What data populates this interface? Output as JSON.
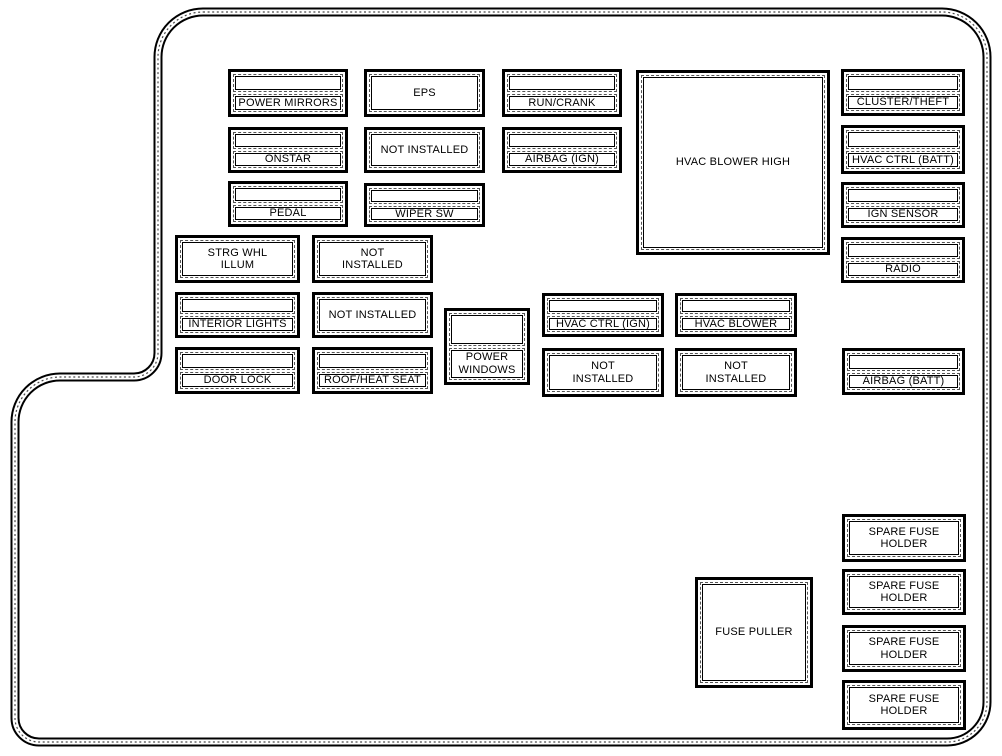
{
  "diagram": {
    "kind": "vehicle-fuse-box-diagram",
    "colors": {
      "line": "#000000",
      "background": "#ffffff"
    }
  },
  "fuses": [
    {
      "id": "power-mirrors",
      "label": "POWER MIRRORS",
      "slots": 2,
      "x": 228,
      "y": 69,
      "w": 120,
      "h": 48
    },
    {
      "id": "eps",
      "label": "EPS",
      "slots": 1,
      "x": 364,
      "y": 69,
      "w": 121,
      "h": 48
    },
    {
      "id": "run-crank",
      "label": "RUN/CRANK",
      "slots": 2,
      "x": 502,
      "y": 69,
      "w": 120,
      "h": 48
    },
    {
      "id": "hvac-blower-high",
      "label": "HVAC BLOWER HIGH",
      "slots": 1,
      "x": 636,
      "y": 70,
      "w": 194,
      "h": 185
    },
    {
      "id": "cluster-theft",
      "label": "CLUSTER/THEFT",
      "slots": 2,
      "x": 841,
      "y": 69,
      "w": 124,
      "h": 47
    },
    {
      "id": "onstar",
      "label": "ONSTAR",
      "slots": 2,
      "x": 228,
      "y": 127,
      "w": 120,
      "h": 46
    },
    {
      "id": "not-installed-a",
      "label": "NOT INSTALLED",
      "slots": 1,
      "x": 364,
      "y": 127,
      "w": 121,
      "h": 46
    },
    {
      "id": "airbag-ign",
      "label": "AIRBAG (IGN)",
      "slots": 2,
      "x": 502,
      "y": 127,
      "w": 120,
      "h": 46
    },
    {
      "id": "hvac-ctrl-batt",
      "label": "HVAC CTRL (BATT)",
      "slots": 2,
      "x": 841,
      "y": 125,
      "w": 124,
      "h": 49
    },
    {
      "id": "pedal",
      "label": "PEDAL",
      "slots": 2,
      "x": 228,
      "y": 181,
      "w": 120,
      "h": 46
    },
    {
      "id": "wiper-sw",
      "label": "WIPER SW",
      "slots": 2,
      "x": 364,
      "y": 183,
      "w": 121,
      "h": 44
    },
    {
      "id": "ign-sensor",
      "label": "IGN SENSOR",
      "slots": 2,
      "x": 841,
      "y": 182,
      "w": 124,
      "h": 46
    },
    {
      "id": "radio",
      "label": "RADIO",
      "slots": 2,
      "x": 841,
      "y": 237,
      "w": 124,
      "h": 46
    },
    {
      "id": "strg-whl-illum",
      "label": "STRG WHL\nILLUM",
      "slots": 1,
      "x": 175,
      "y": 235,
      "w": 125,
      "h": 48
    },
    {
      "id": "not-installed-b",
      "label": "NOT\nINSTALLED",
      "slots": 1,
      "x": 312,
      "y": 235,
      "w": 121,
      "h": 48
    },
    {
      "id": "interior-lights",
      "label": "INTERIOR LIGHTS",
      "slots": 2,
      "x": 175,
      "y": 292,
      "w": 125,
      "h": 46
    },
    {
      "id": "not-installed-c",
      "label": "NOT INSTALLED",
      "slots": 1,
      "x": 312,
      "y": 292,
      "w": 121,
      "h": 46
    },
    {
      "id": "hvac-ctrl-ign",
      "label": "HVAC CTRL (IGN)",
      "slots": 2,
      "x": 542,
      "y": 293,
      "w": 122,
      "h": 44
    },
    {
      "id": "hvac-blower",
      "label": "HVAC BLOWER",
      "slots": 2,
      "x": 675,
      "y": 293,
      "w": 122,
      "h": 44
    },
    {
      "id": "door-lock",
      "label": "DOOR LOCK",
      "slots": 2,
      "x": 175,
      "y": 347,
      "w": 125,
      "h": 47
    },
    {
      "id": "roof-heat-seat",
      "label": "ROOF/HEAT SEAT",
      "slots": 2,
      "x": 312,
      "y": 347,
      "w": 121,
      "h": 47
    },
    {
      "id": "power-windows",
      "label": "POWER\nWINDOWS",
      "slots": 2,
      "x": 444,
      "y": 308,
      "w": 86,
      "h": 77
    },
    {
      "id": "not-installed-d",
      "label": "NOT\nINSTALLED",
      "slots": 1,
      "x": 542,
      "y": 348,
      "w": 122,
      "h": 49
    },
    {
      "id": "not-installed-e",
      "label": "NOT\nINSTALLED",
      "slots": 1,
      "x": 675,
      "y": 348,
      "w": 122,
      "h": 49
    },
    {
      "id": "airbag-batt",
      "label": "AIRBAG (BATT)",
      "slots": 2,
      "x": 842,
      "y": 348,
      "w": 123,
      "h": 47
    },
    {
      "id": "fuse-puller",
      "label": "FUSE PULLER",
      "slots": 1,
      "x": 695,
      "y": 577,
      "w": 118,
      "h": 111
    },
    {
      "id": "spare-fuse-holder-1",
      "label": "SPARE FUSE\nHOLDER",
      "slots": 1,
      "x": 842,
      "y": 514,
      "w": 124,
      "h": 48
    },
    {
      "id": "spare-fuse-holder-2",
      "label": "SPARE FUSE\nHOLDER",
      "slots": 1,
      "x": 842,
      "y": 569,
      "w": 124,
      "h": 46
    },
    {
      "id": "spare-fuse-holder-3",
      "label": "SPARE FUSE\nHOLDER",
      "slots": 1,
      "x": 842,
      "y": 625,
      "w": 124,
      "h": 47
    },
    {
      "id": "spare-fuse-holder-4",
      "label": "SPARE FUSE\nHOLDER",
      "slots": 1,
      "x": 842,
      "y": 680,
      "w": 124,
      "h": 50
    }
  ]
}
